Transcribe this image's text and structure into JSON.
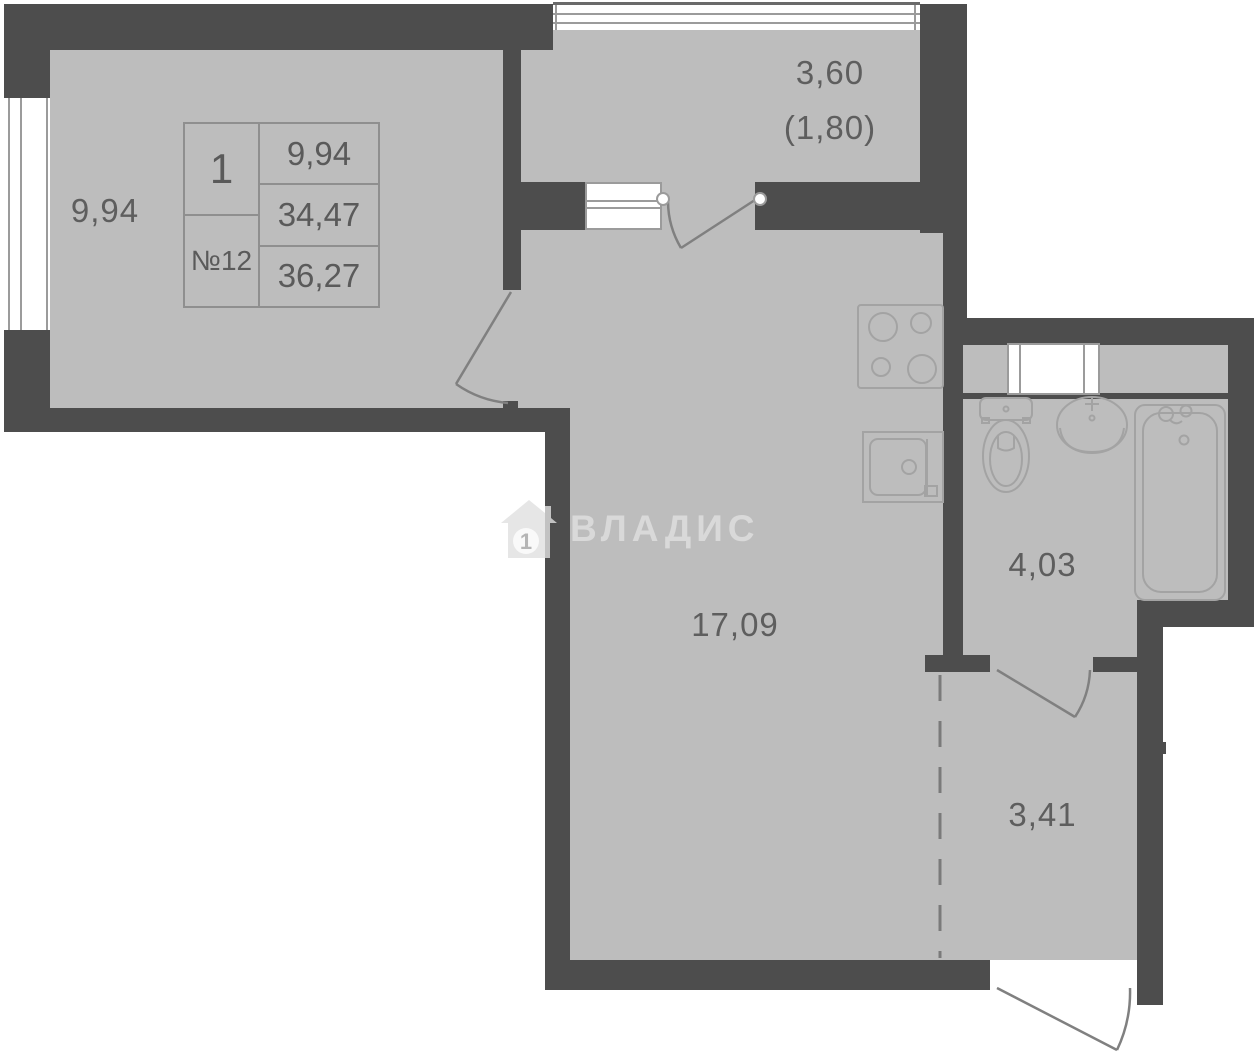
{
  "plan_title": "studio apartment floor plan",
  "unit_card": {
    "rooms_count": "1",
    "unit_number": "№12",
    "living_area": "9,94",
    "area_no_balcony": "34,47",
    "total_area": "36,27"
  },
  "labels": {
    "living_room": "9,94",
    "balcony_full": "3,60",
    "balcony_reduced": "(1,80)",
    "main_room": "17,09",
    "bathroom": "4,03",
    "hallway": "3,41"
  },
  "watermark": {
    "text": "ВЛАДИС",
    "icon": "house-with-number-icon",
    "number": "1"
  },
  "colors": {
    "wall": "#4d4d4d",
    "floor": "#bdbdbd",
    "outside": "#ffffff",
    "fixture_stroke": "#a3a3a3",
    "door_stroke": "#808080",
    "label_text": "#5e5e5e",
    "watermark": "#e0e0e0"
  },
  "fixtures": [
    "stove",
    "kitchen-sink",
    "toilet",
    "washbasin",
    "bathtub"
  ],
  "openings": [
    "living-room-door",
    "balcony-door",
    "bathroom-door",
    "entry-door",
    "left-window",
    "balcony-glazing",
    "balcony-window-block",
    "duct-window-block"
  ]
}
